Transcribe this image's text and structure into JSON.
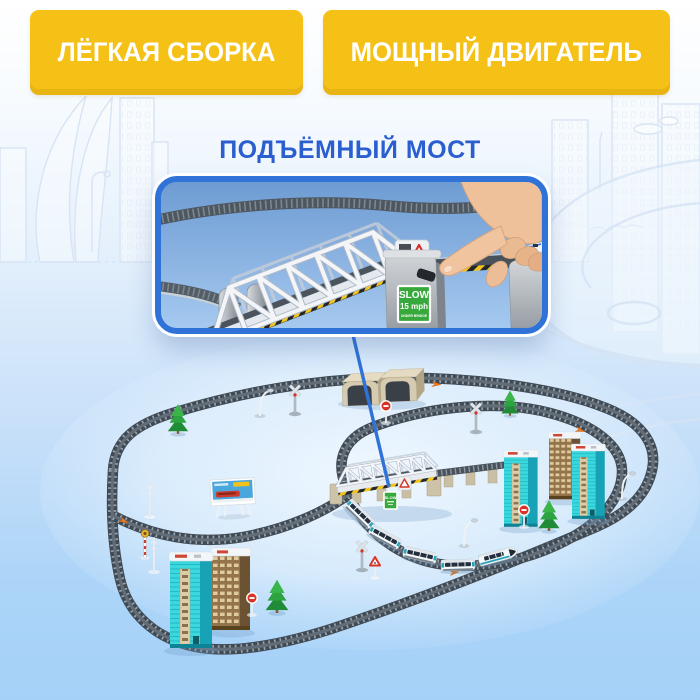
{
  "badges": {
    "left": "ЛЁГКАЯ СБОРКА",
    "right": "МОЩНЫЙ ДВИГАТЕЛЬ"
  },
  "title": {
    "text": "ПОДЪЁМНЫЙ МОСТ"
  },
  "inset": {
    "slow_sign": {
      "line1": "SLOW",
      "line2": "15 mph",
      "line3": "UNDER BRIDGE"
    }
  },
  "layout": {
    "bridge_sign": "SLOW"
  },
  "colors": {
    "badge_bg": "#f5c117",
    "badge_text": "#ffffff",
    "title_text": "#2b5fd0",
    "inset_border": "#2f72d8",
    "pointer_line": "#2f72d8",
    "background_bottom": "#a5d1f8",
    "slow_sign_green": "#37a83c",
    "track_gray": "#3f4a54",
    "train_teal": "#2aa3b8",
    "building_teal": "#3bd8de"
  }
}
